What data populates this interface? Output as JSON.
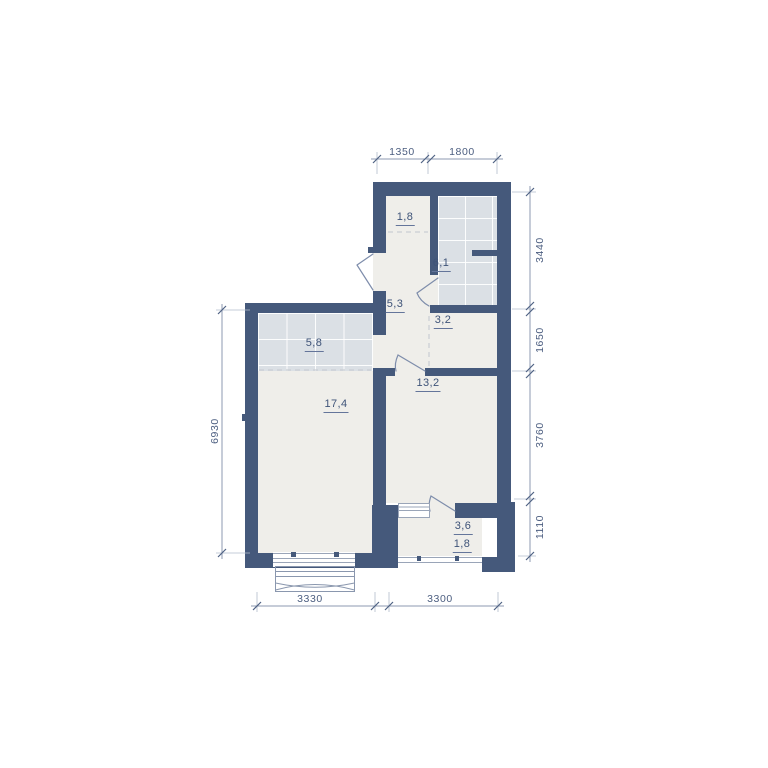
{
  "plan": {
    "rooms": [
      {
        "name": "wardrobe",
        "area": "1,8"
      },
      {
        "name": "bathroom",
        "area": "6,1"
      },
      {
        "name": "hallway",
        "area": "5,3"
      },
      {
        "name": "nook",
        "area": "3,2"
      },
      {
        "name": "kitchen-zone",
        "area": "5,8"
      },
      {
        "name": "living-room",
        "area": "17,4"
      },
      {
        "name": "bedroom",
        "area": "13,2"
      },
      {
        "name": "balcony",
        "area": "3,6",
        "area_reduced": "1,8"
      }
    ],
    "dimensions": {
      "top": [
        "1350",
        "1800"
      ],
      "right": [
        "3440",
        "1650",
        "3760",
        "1110"
      ],
      "left": [
        "6930"
      ],
      "bottom": [
        "3330",
        "3300"
      ]
    },
    "colors": {
      "wall": "#45597B",
      "floor": "#EFEEEA",
      "tile": "#DBE0E5",
      "door_line": "#7E8DAB",
      "dim_line": "#8D9AB1",
      "room_text": "#3E5378",
      "dim_text": "#4C5E80"
    }
  }
}
